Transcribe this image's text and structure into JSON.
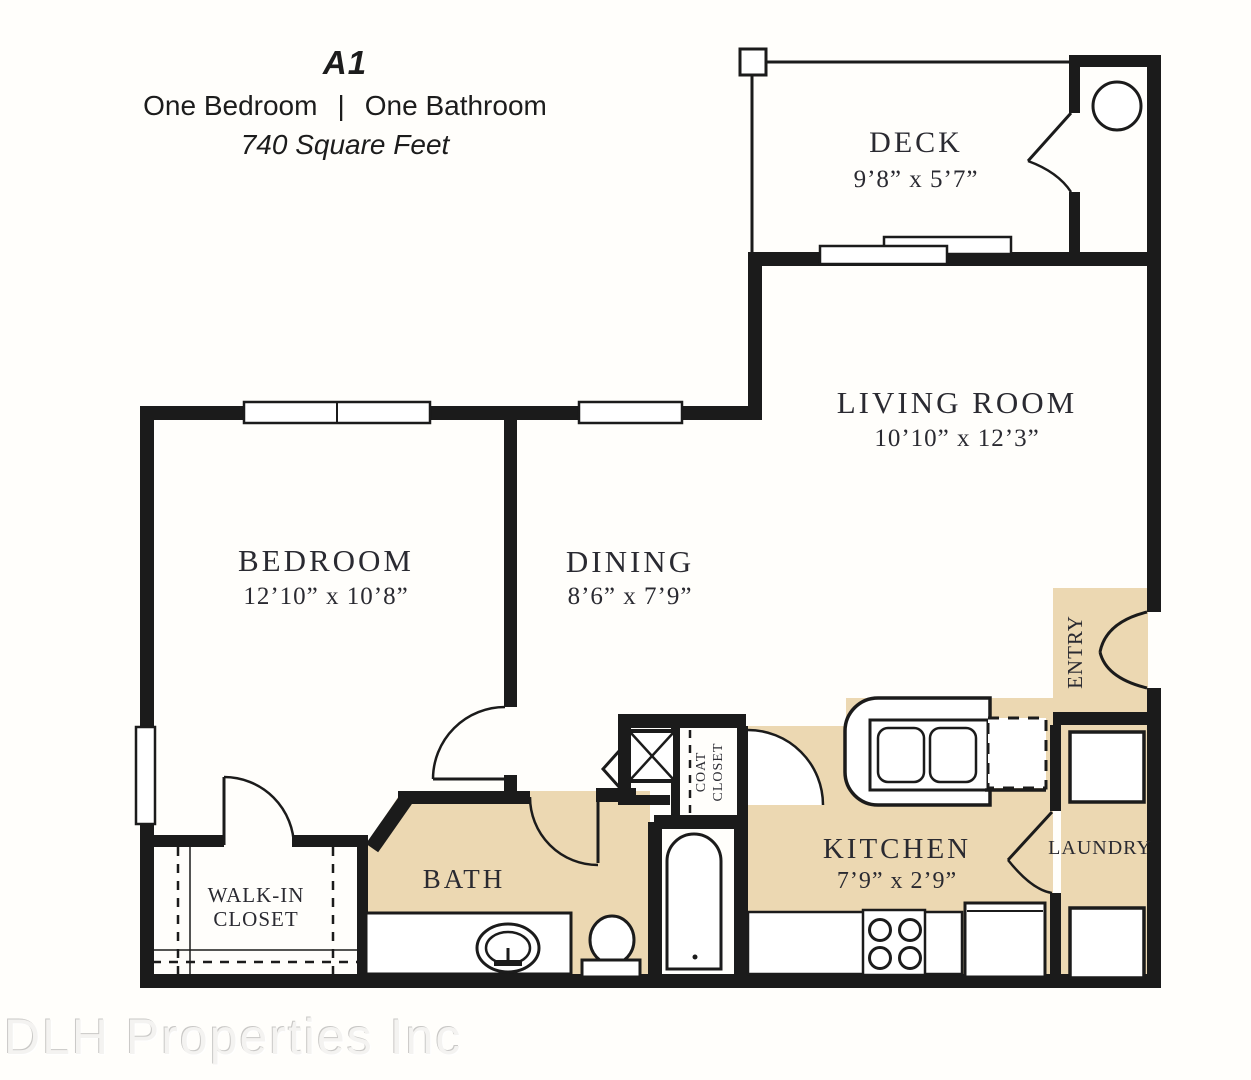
{
  "title": {
    "plan_code": "A1",
    "subtitle_left": "One Bedroom",
    "subtitle_divider": "|",
    "subtitle_right": "One Bathroom",
    "area": "740 Square Feet"
  },
  "watermark": "DLH Properties Inc",
  "colors": {
    "floor_accent": "#ecd8b2",
    "wall": "#1b1b1b",
    "label_text": "#2a2a31"
  },
  "rooms": {
    "deck": {
      "name": "DECK",
      "dims": "9’8” x 5’7”"
    },
    "living_room": {
      "name": "LIVING ROOM",
      "dims": "10’10” x 12’3”"
    },
    "bedroom": {
      "name": "BEDROOM",
      "dims": "12’10” x 10’8”"
    },
    "dining": {
      "name": "DINING",
      "dims": "8’6” x 7’9”"
    },
    "kitchen": {
      "name": "KITCHEN",
      "dims": "7’9” x 2’9”"
    },
    "laundry": {
      "name": "LAUNDRY"
    },
    "bath": {
      "name": "BATH"
    },
    "entry": {
      "name": "ENTRY"
    },
    "walk_in_closet": {
      "line1": "WALK-IN",
      "line2": "CLOSET"
    },
    "coat_closet": {
      "line1": "COAT",
      "line2": "CLOSET"
    }
  }
}
